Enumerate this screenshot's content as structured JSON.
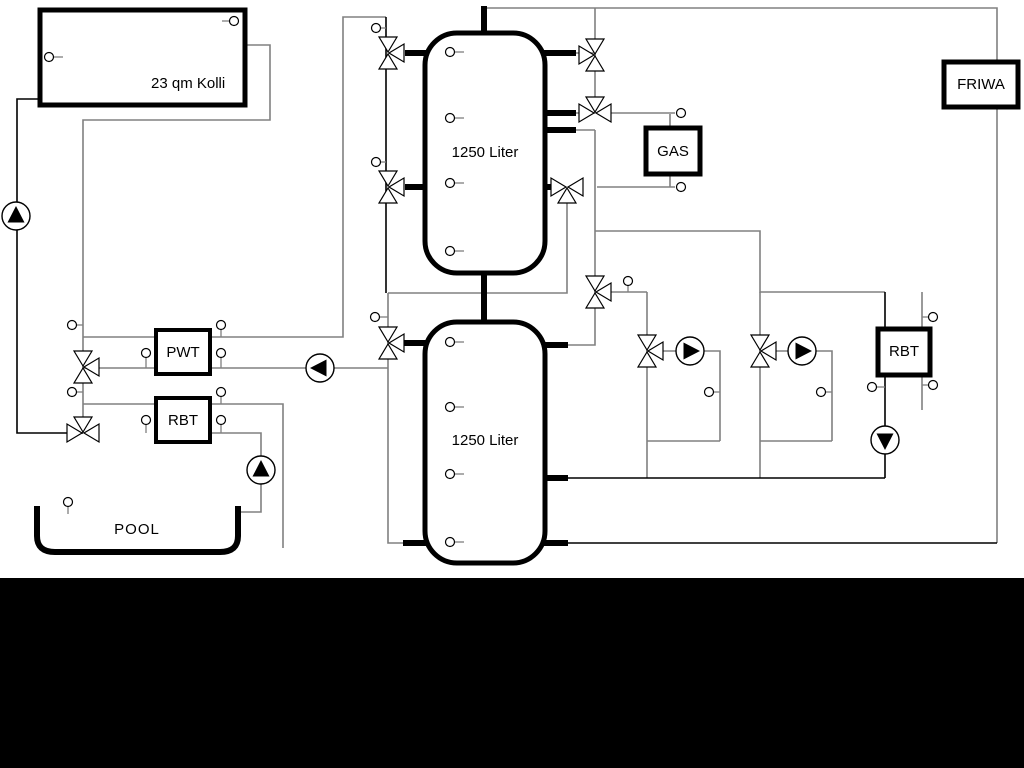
{
  "labels": {
    "collector": "23 qm Kolli",
    "tank_top": "1250 Liter",
    "tank_bottom": "1250 Liter",
    "pwt": "PWT",
    "rbt_left": "RBT",
    "rbt_right": "RBT",
    "gas": "GAS",
    "friwa": "FRIWA",
    "pool": "POOL"
  },
  "colors": {
    "pipe_gray": "#808080",
    "pipe_black": "#000000",
    "device_border": "#000000",
    "device_fill": "#ffffff",
    "background": "#ffffff",
    "bottom_bar": "#000000"
  },
  "icons": {
    "pump": "circle-with-filled-triangle",
    "three_way_valve": "bowtie-with-side-triangle",
    "sensor": "small-circle-probe"
  }
}
